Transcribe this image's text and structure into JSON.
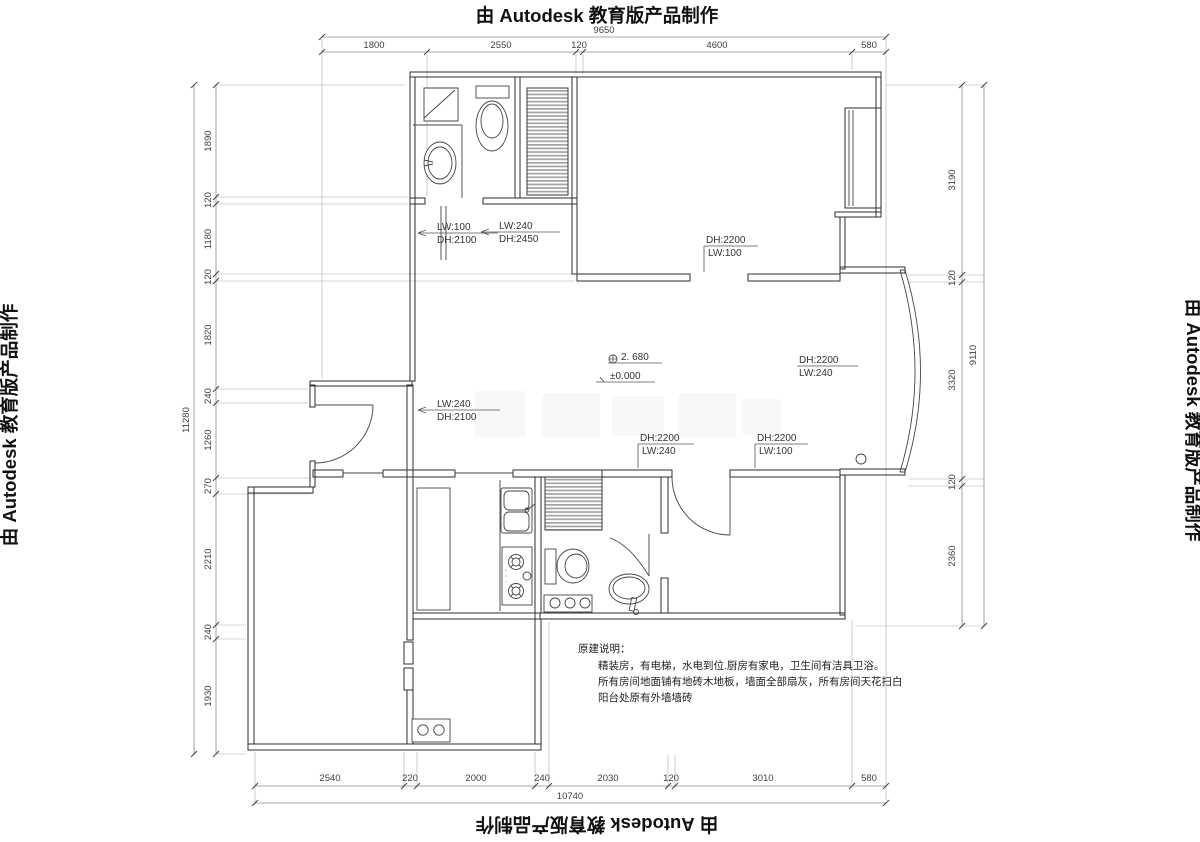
{
  "branding": {
    "banner": "由 Autodesk 教育版产品制作"
  },
  "dims": {
    "top": {
      "total": "9650",
      "segments": [
        "1800",
        "2550",
        "120",
        "4600",
        "580"
      ]
    },
    "bottom": {
      "total": "10740",
      "segments": [
        "2540",
        "220",
        "2000",
        "240",
        "2030",
        "120",
        "3010",
        "580"
      ]
    },
    "left": {
      "total": "11280",
      "segments": [
        "1890",
        "120",
        "1180",
        "120",
        "1820",
        "240",
        "1260",
        "270",
        "2210",
        "240",
        "1930"
      ]
    },
    "right": {
      "total": "9110",
      "segments": [
        "3190",
        "120",
        "3320",
        "120",
        "2360"
      ]
    }
  },
  "labels": [
    {
      "l1": "LW:100",
      "l2": "DH:2100"
    },
    {
      "l1": "LW:240",
      "l2": "DH:2450"
    },
    {
      "l1": "DH:2200",
      "l2": "LW:100"
    },
    {
      "l1": "DH:2200",
      "l2": "LW:240"
    },
    {
      "l1": "LW:240",
      "l2": "DH:2100"
    },
    {
      "l1": "DH:2200",
      "l2": "LW:240"
    },
    {
      "l1": "DH:2200",
      "l2": "LW:100"
    }
  ],
  "levels": {
    "upper": "2. 680",
    "zero": "±0.000"
  },
  "notes": {
    "title": "原建说明：",
    "line1": "精装房，有电梯，水电到位.厨房有家电，卫生间有洁具卫浴。",
    "line2": "所有房间地面铺有地砖木地板，墙面全部扇灰，所有房间天花扫白",
    "line3": "阳台处原有外墙墙砖"
  }
}
